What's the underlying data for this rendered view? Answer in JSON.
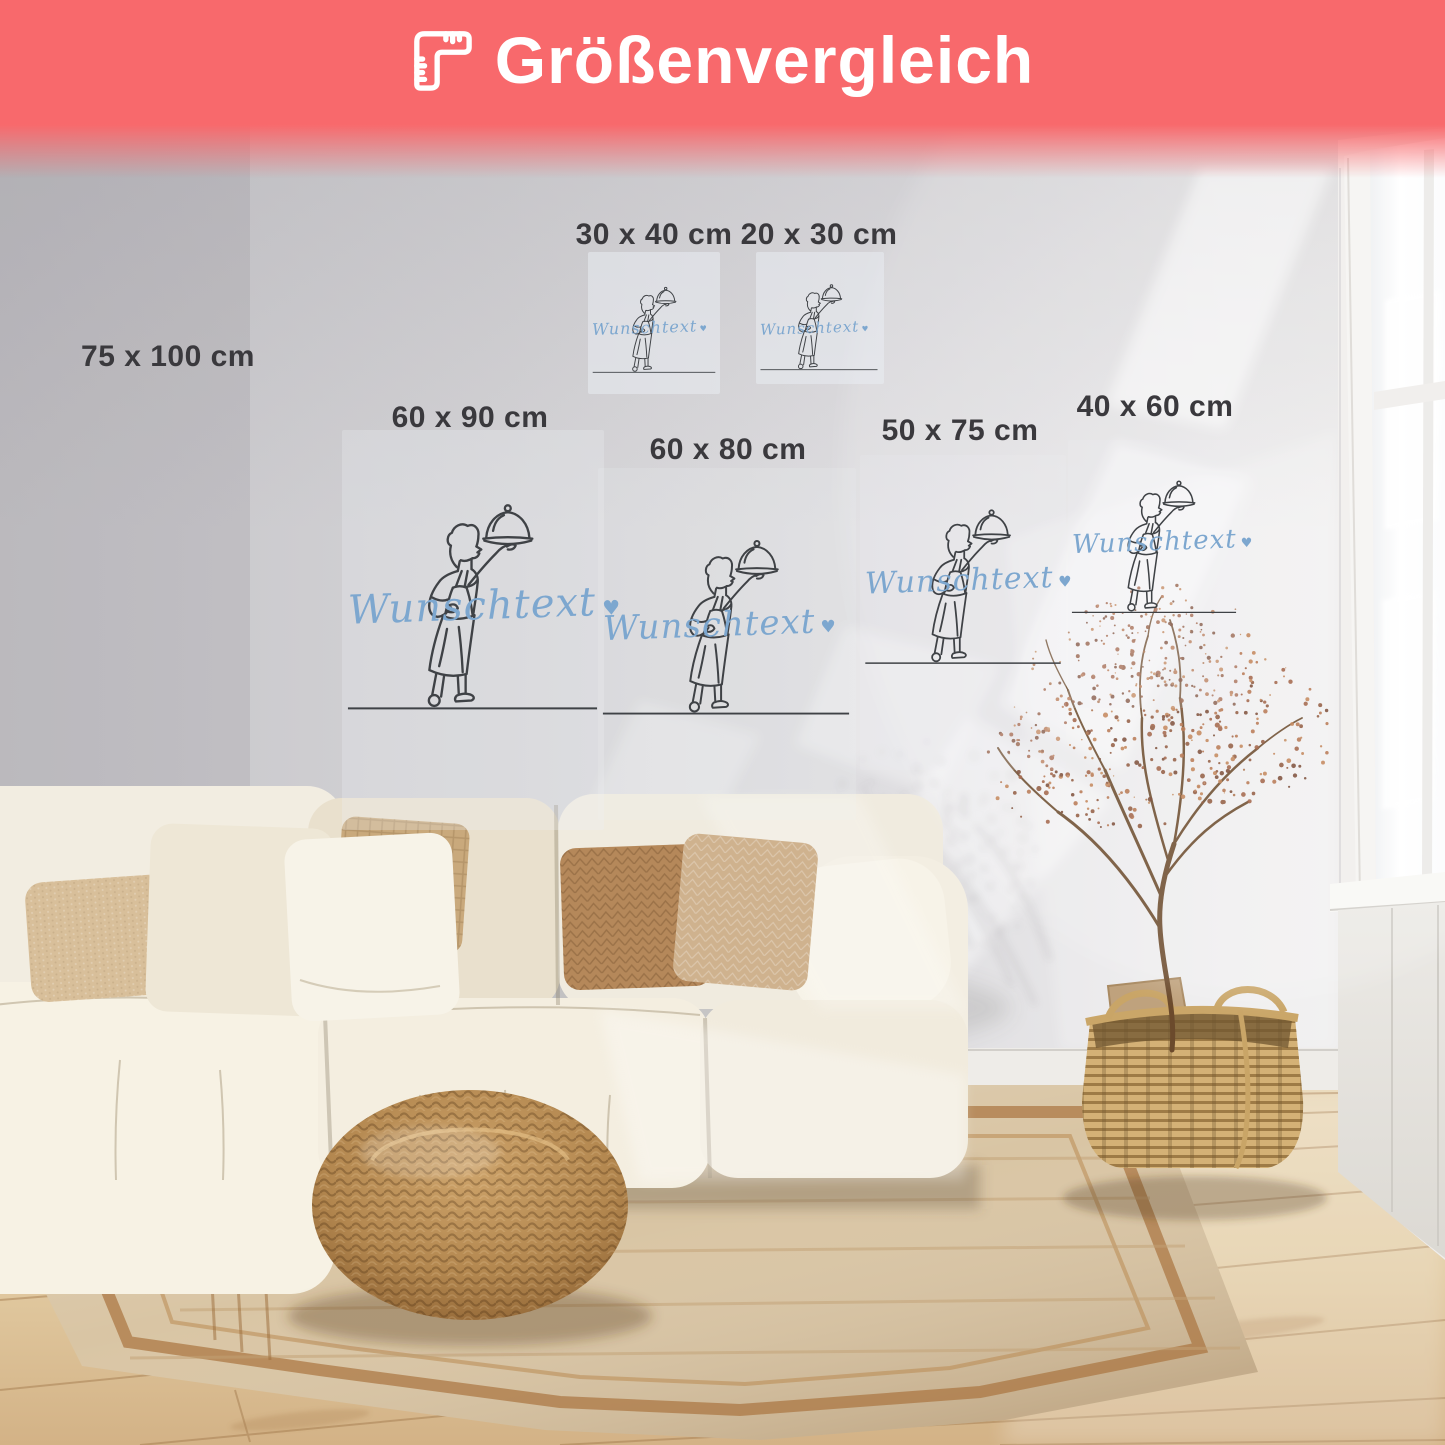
{
  "banner": {
    "title": "Größenvergleich",
    "icon": "ruler-icon",
    "background_color": "#f8696c",
    "text_color": "#ffffff"
  },
  "sizes": [
    {
      "label": "75 x 100 cm"
    },
    {
      "label": "30 x 40 cm"
    },
    {
      "label": "20 x 30 cm"
    },
    {
      "label": "60 x 90 cm"
    },
    {
      "label": "60 x 80 cm"
    },
    {
      "label": "50 x 75 cm"
    },
    {
      "label": "40 x 60 cm"
    }
  ],
  "artwork": {
    "wunschtext": "Wunschtext",
    "heart": "♥",
    "subject": "chef-serving-cloche-one-line-drawing",
    "text_color": "#7da7cf",
    "line_color": "#3f4246"
  },
  "scene": {
    "palette": {
      "wall": "#d7d6d9",
      "floor_wood": "#e2cba2",
      "rug": "#d9c5a4",
      "rug_border": "#a9743e",
      "sofa": "#f3eee2",
      "pouf": "#b98e5b",
      "basket": "#d4b176",
      "dried_plant": "#9a5637",
      "window_light": "#ffffff"
    }
  }
}
